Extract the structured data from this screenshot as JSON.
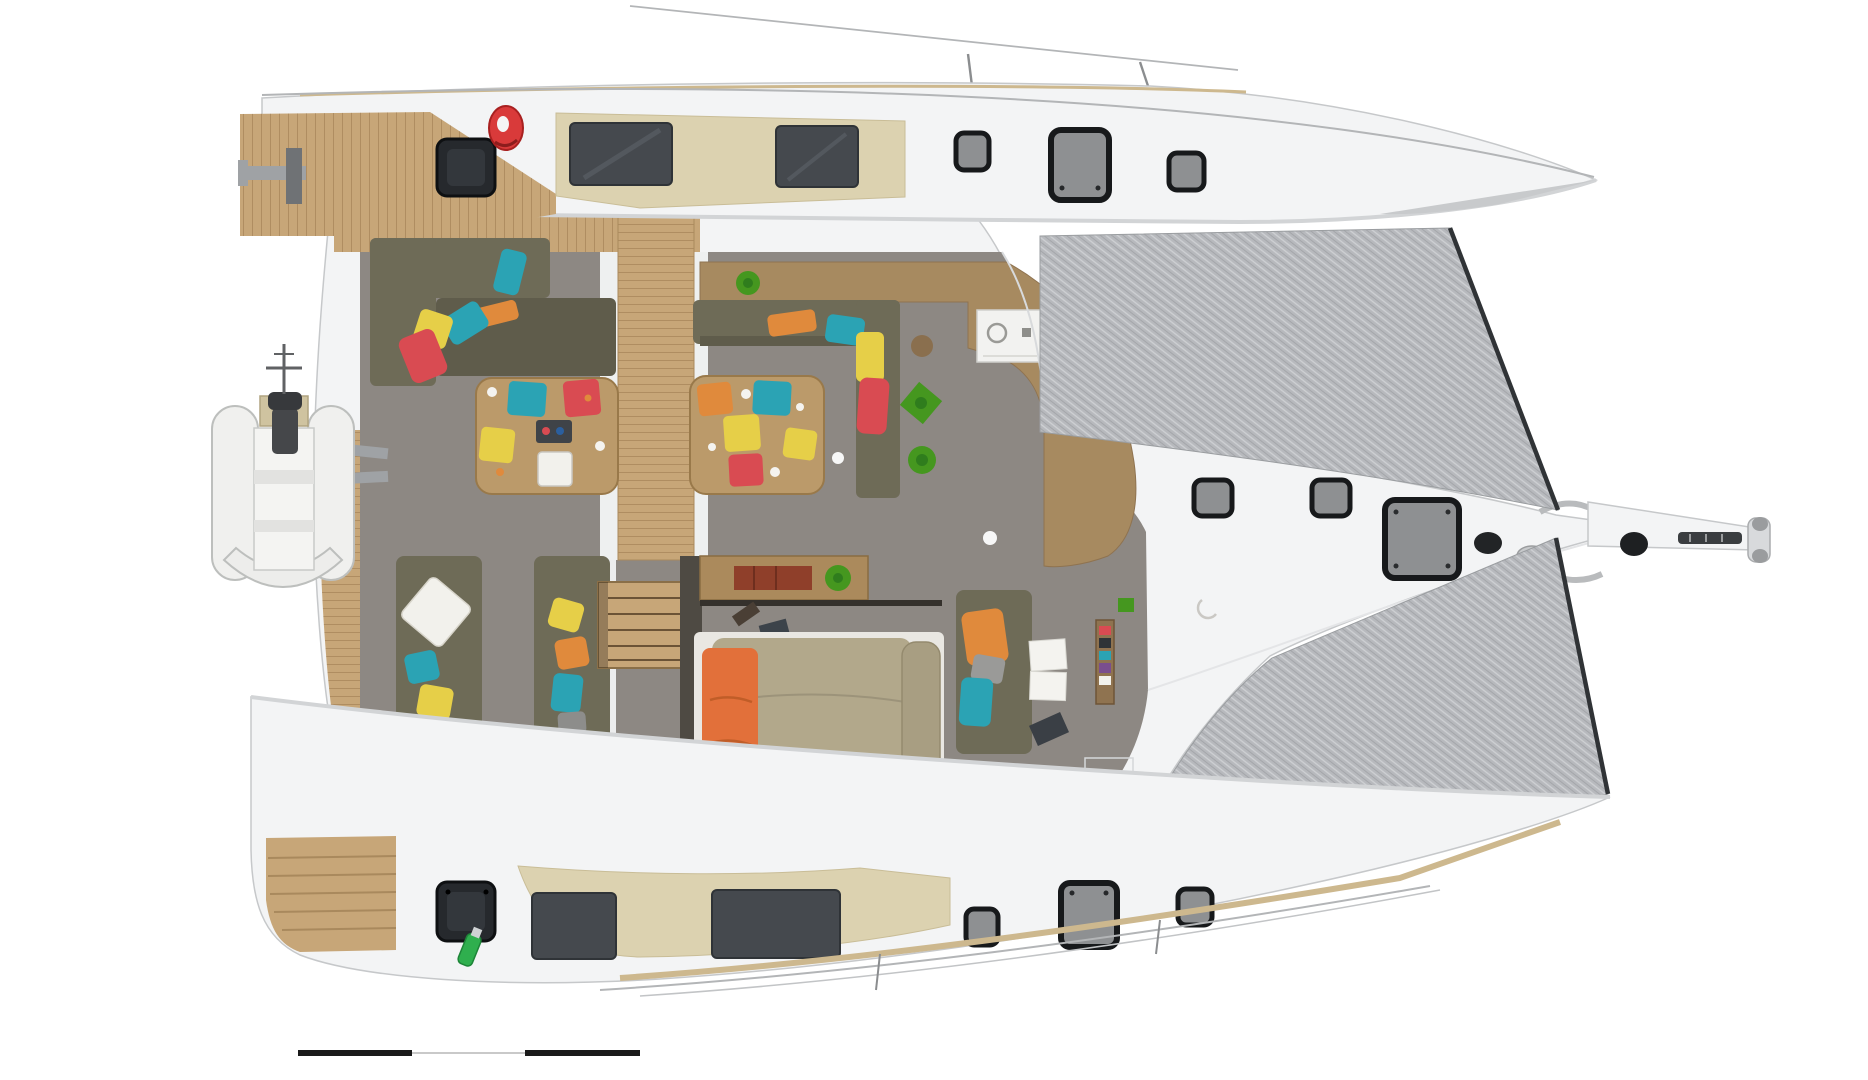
{
  "scene": {
    "description": "Top-down 3D rendered deck/floor plan of a sailing catamaran-style yacht, bow pointing right: twin outer hulls with deck hatches and cabin windows, central saloon with galley and dining sofas, open cockpit with two cocktail tables and colorful seat cushions, aft lounge sofas, center owner cabin with large bed and orange blanket, grey bow trampolines, bowsprit, and a dinghy hanging on davits at the stern. A black segmented scale bar sits at bottom left. No text labels are visible.",
    "view": "plan view (from above)",
    "no_visible_text": true
  },
  "colors": {
    "bg": "#ffffff",
    "hull": "#f3f4f5",
    "hullLine": "#c6c8ca",
    "teak": "#c7a678",
    "teakLine": "#a9895d",
    "coaming": "#dcd2b0",
    "glass": "#45494e",
    "hatchFrame": "#17191b",
    "hatchGlass": "#8e9092",
    "hatchDark": "#26292d",
    "hatchDarkInner": "#33373c",
    "tramp": "#b7b9bd",
    "trampEdge": "#303336",
    "floor": "#8d8883",
    "galley": "#a78a60",
    "wood": "#bb9a6a",
    "woodLine": "#99794a",
    "sofa": "#6e6b57",
    "sofaDeep": "#5f5c4b",
    "bedBase": "#e9e7e2",
    "bed": "#b2a88b",
    "bedRoll": "#a89e82",
    "orange": "#e08a3c",
    "blanket": "#e2703a",
    "teal": "#2ba3b4",
    "red": "#d94b52",
    "yellow": "#e6cf48",
    "white": "#f2f1ec",
    "plant": "#45971f",
    "plantDeep": "#2f7d1d",
    "ring": "#d93a3a",
    "bottle": "#2faf4e",
    "metal": "#9fa2a5",
    "metalDark": "#6f7275",
    "bulkhead": "#4e4a43",
    "door": "#8f7352",
    "paper": "#f4f3ef",
    "railGray": "#b3b5b7",
    "railWood": "#cdb88e",
    "scaleDark": "#1a1a1a",
    "scaleLite": "#c9c9c9"
  },
  "inventory": {
    "hulls": 2,
    "trampolines": 2,
    "deck_hatches_top_hull": 3,
    "deck_hatches_bottom_hull": 3,
    "dark_stern_hatches": 2,
    "foredeck_hatches_center": 3,
    "hull_windows_top": 2,
    "hull_windows_bottom": 2,
    "cockpit_tables": 2,
    "table_seat_cushions": 10,
    "sofas": 5,
    "beds": 1,
    "dinghy": 1,
    "life_ring": 1,
    "plants": 5,
    "cleats": 2,
    "scale_bar_segments": 3
  },
  "scale_bar": {
    "style": "alternating black / light segments",
    "segments": [
      "dark",
      "light",
      "dark"
    ]
  }
}
